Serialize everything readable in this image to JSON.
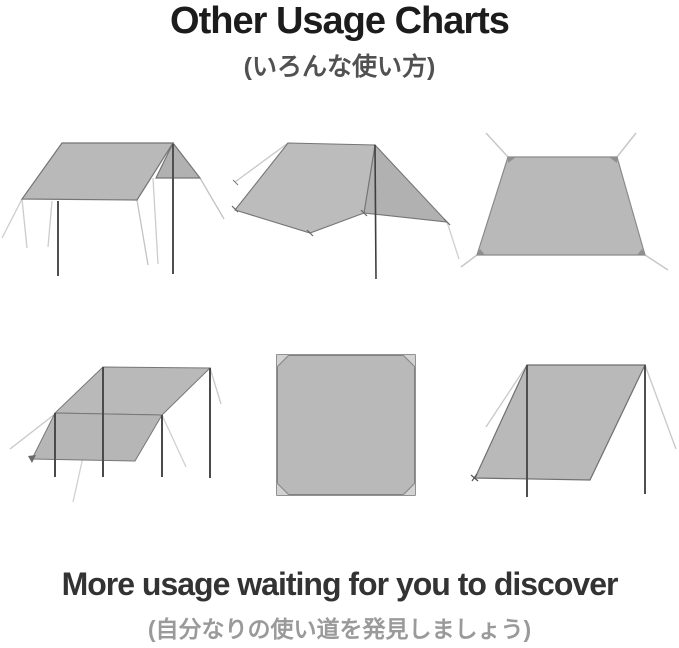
{
  "header": {
    "title": "Other Usage Charts",
    "subtitle": "(いろんな使い方)"
  },
  "footer": {
    "message": "More usage waiting for you to discover",
    "submessage": "(自分なりの使い道を発見しましょう)"
  },
  "diagrams": [
    {
      "name": "rect-canopy-two-poles-diagram"
    },
    {
      "name": "a-frame-shelter-diagram"
    },
    {
      "name": "ground-sheet-trapezoid-diagram"
    },
    {
      "name": "lean-to-four-poles-diagram"
    },
    {
      "name": "flat-square-sheet-diagram"
    },
    {
      "name": "slanted-windbreak-diagram"
    }
  ],
  "colors": {
    "background": "#ffffff",
    "tarp_fill": "#b9b9b9",
    "tarp_outline": "#757575",
    "pole": "#4f4f4f",
    "guy_line": "#c8c8c8",
    "title_text": "#1c1c1c",
    "subtitle_text": "#515151",
    "footer_text": "#333333",
    "footer_sub_text": "#9a9a9a"
  }
}
